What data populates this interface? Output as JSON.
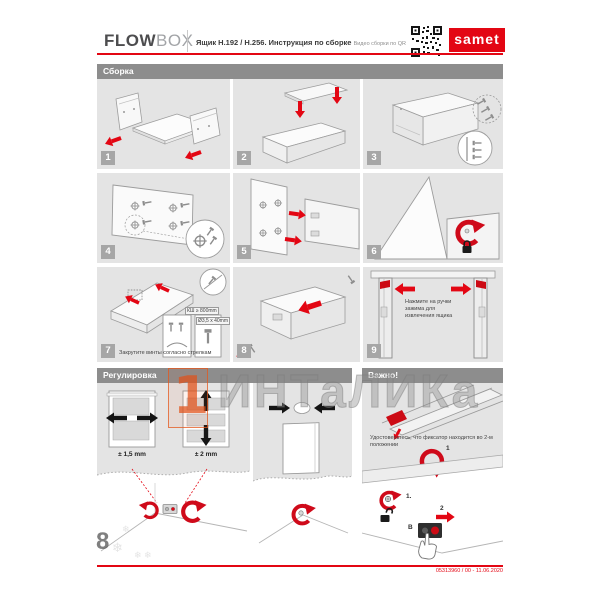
{
  "header": {
    "brand_bold": "FLOW",
    "brand_light": "BOX",
    "title": "Ящик H.192 / H.256. Инструкция по сборке",
    "qr_caption": "Видео сборки по QR",
    "logo_text": "samet"
  },
  "sections": {
    "assembly": {
      "title": "Сборка",
      "steps": [
        {
          "num": "1"
        },
        {
          "num": "2"
        },
        {
          "num": "3"
        },
        {
          "num": "4"
        },
        {
          "num": "5"
        },
        {
          "num": "6"
        },
        {
          "num": "7",
          "caption": "Закрутите винты согласно стрелкам",
          "label_kb": "КШ ≥ 800mm",
          "label_screw": "Ø3,5 x 40mm"
        },
        {
          "num": "8"
        },
        {
          "num": "9",
          "note": "Нажмите на ручки зажима для извлечения ящика"
        }
      ]
    },
    "adjustment": {
      "title": "Регулировка",
      "tolerance_side": "± 1,5 mm",
      "tolerance_height": "± 2 mm"
    },
    "important": {
      "title": "Важно!",
      "note": "Удостоверьтесь, что фиксатор находится во 2-м положении",
      "marker_arrow": "1",
      "marker_step1": "1.",
      "marker_step2": "2",
      "marker_unit": "B"
    }
  },
  "watermark": {
    "text": "ИНТаЛИКа",
    "logo_glyph": "1"
  },
  "footer": {
    "doc_code": "05313960 / 00 - 11.06.2020"
  },
  "colors": {
    "accent": "#e30613",
    "section_bar": "#8d8d8d",
    "panel": "#e4e4e4",
    "badge": "#a6a6a6"
  }
}
